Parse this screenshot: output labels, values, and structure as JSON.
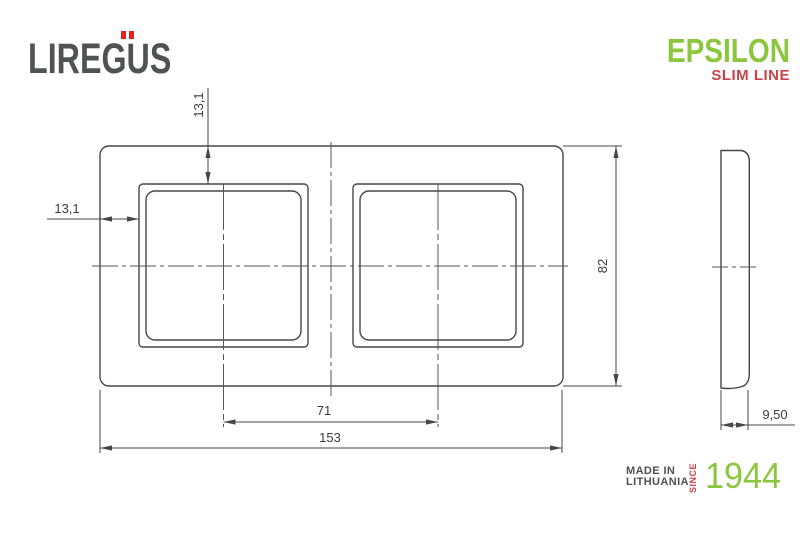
{
  "brand": {
    "name": "LIREGUS",
    "umlaut_color": "#e1251b",
    "text_color": "#515254"
  },
  "product": {
    "name": "EPSILON",
    "tagline": "SLIM LINE",
    "name_color": "#8cc63e",
    "tagline_color": "#cb4248"
  },
  "drawing": {
    "type": "technical-dimension-drawing",
    "subject": "2-gang frame, front view and side view",
    "front_view": {
      "dim_top_offset": "13,1",
      "dim_left_offset": "13,1",
      "dim_height": "82",
      "dim_center_distance": "71",
      "dim_width": "153"
    },
    "side_view": {
      "dim_depth": "9,50"
    },
    "line_color": "#46474a"
  },
  "footer": {
    "origin_line1": "MADE IN",
    "origin_line2": "LITHUANIA",
    "since_label": "SINCE",
    "year": "1944",
    "year_color": "#8cc63e",
    "since_color": "#cb4248"
  }
}
